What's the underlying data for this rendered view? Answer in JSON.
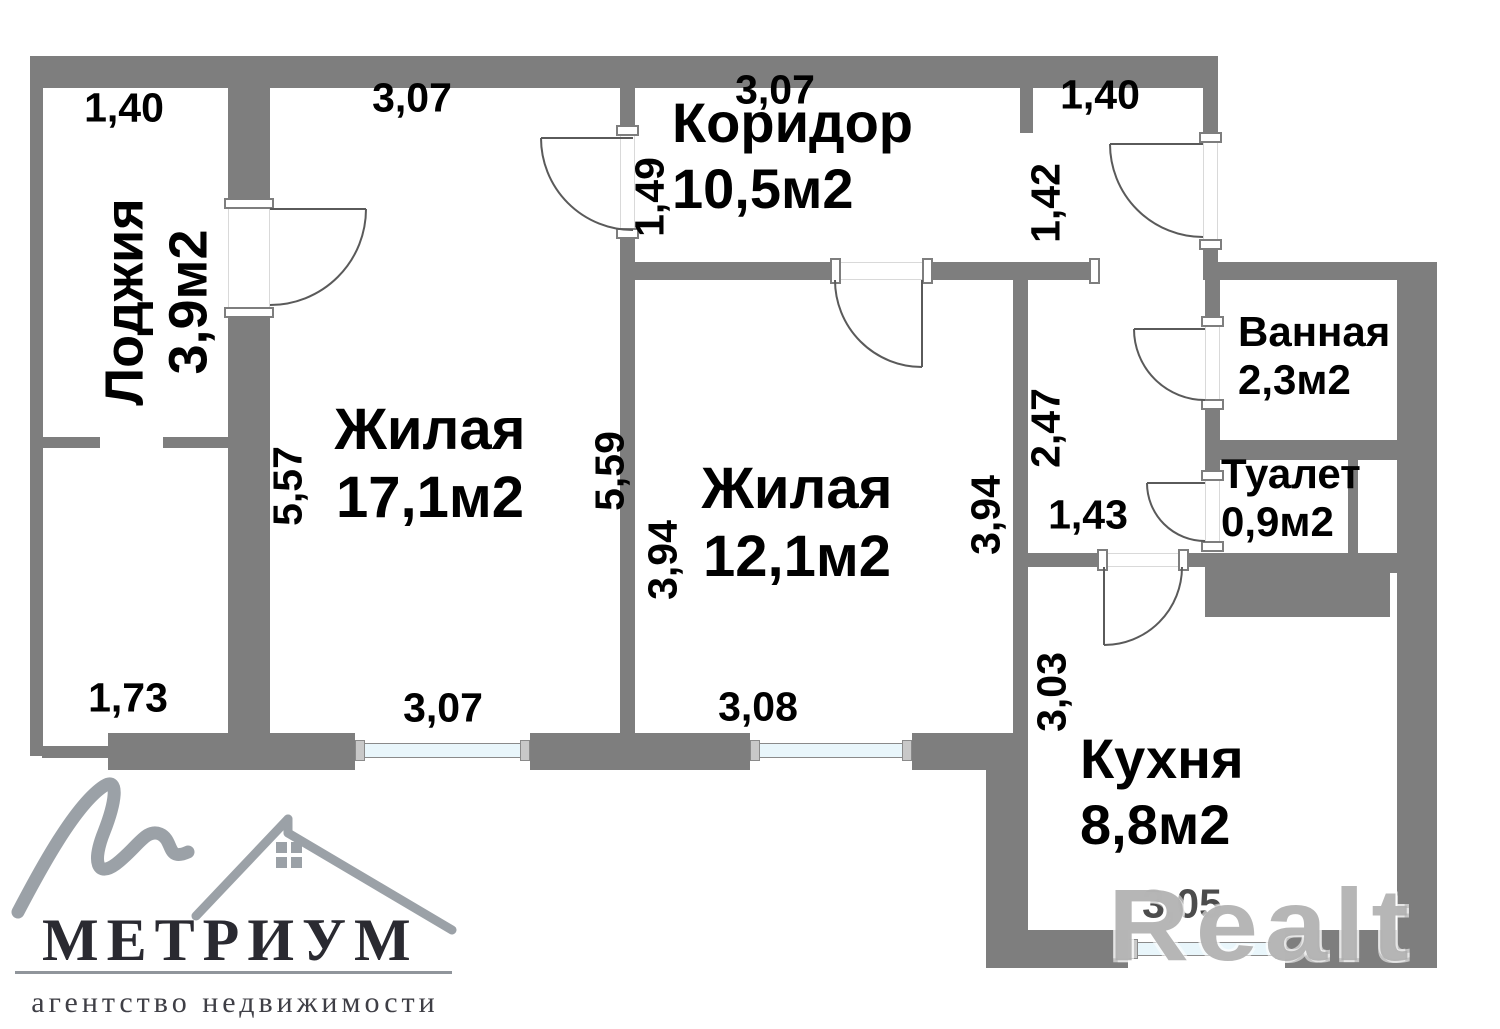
{
  "rooms": {
    "loggia": {
      "name": "Лоджия",
      "area": "3,9м2"
    },
    "room1": {
      "name": "Жилая",
      "area": "17,1м2"
    },
    "corridor": {
      "name": "Коридор",
      "area": "10,5м2"
    },
    "room2": {
      "name": "Жилая",
      "area": "12,1м2"
    },
    "bathroom": {
      "name": "Ванная",
      "area": "2,3м2"
    },
    "toilet": {
      "name": "Туалет",
      "area": "0,9м2"
    },
    "kitchen": {
      "name": "Кухня",
      "area": "8,8м2"
    }
  },
  "dimensions": {
    "loggia_top": "1,40",
    "room1_top": "3,07",
    "corridor_top": "3,07",
    "entry_top": "1,40",
    "corridor_left": "1,49",
    "entry_left": "1,42",
    "room1_left": "5,57",
    "room1_right": "5,59",
    "room2_left": "3,94",
    "room2_right": "3,94",
    "hall_right": "2,47",
    "hall_width": "1,43",
    "loggia_bottom": "1,73",
    "room1_bottom": "3,07",
    "room2_bottom": "3,08",
    "kitchen_left": "3,03",
    "kitchen_bottom": "3,05"
  },
  "logo": {
    "brand": "МЕТРИУМ",
    "tagline": "агентство недвижимости"
  },
  "watermark": {
    "text": "Realt"
  },
  "colors": {
    "wall": "#7e7e7e",
    "window_glass": "#e9f6fb",
    "logo_accent": "#9ba1a7",
    "logo_text": "#2a2a31"
  }
}
